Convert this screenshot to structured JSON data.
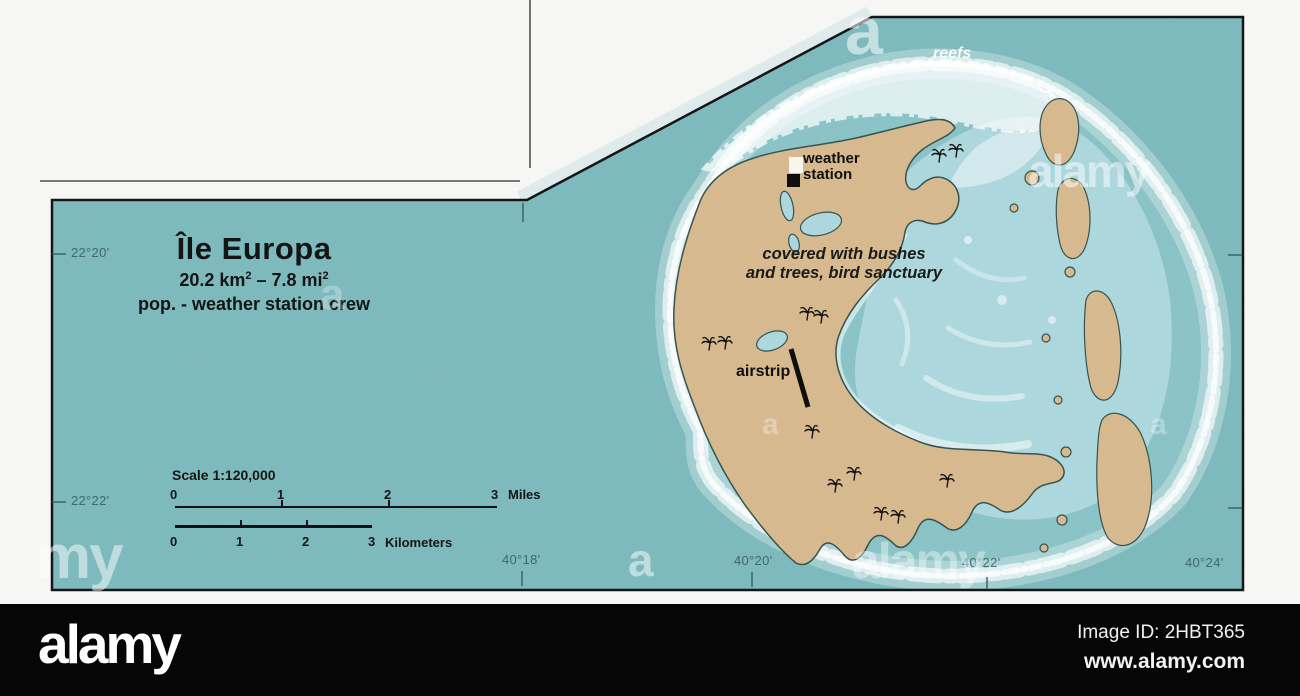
{
  "title_block": {
    "title": "Île Europa",
    "area_base1": "20.2 km",
    "area_sup1": "2",
    "area_base2": " – 7.8 mi",
    "area_sup2": "2",
    "population": "pop. - weather station crew"
  },
  "scale_block": {
    "label": "Scale 1:120,000",
    "miles_ticks": [
      "0",
      "1",
      "2",
      "3"
    ],
    "miles_unit": "Miles",
    "km_ticks": [
      "0",
      "1",
      "2",
      "3"
    ],
    "km_unit": "Kilometers"
  },
  "graticule": {
    "lat_labels": [
      "22°20'",
      "22°22'"
    ],
    "lon_labels": [
      "40°18'",
      "40°20'",
      "40°22'",
      "40°24'"
    ]
  },
  "map_labels": {
    "reefs": "reefs",
    "weather_line1": "weather",
    "weather_line2": "station",
    "vegetation_line1": "covered with bushes",
    "vegetation_line2": "and trees, bird sanctuary",
    "airstrip": "airstrip"
  },
  "watermarks": {
    "big_a": "a",
    "alamy": "alamy",
    "partial_my": "my"
  },
  "alamy_bar": {
    "logo": "alamy",
    "image_id": "Image ID: 2HBT365",
    "website": "www.alamy.com"
  },
  "colors": {
    "ocean": "#7ab8bb",
    "land": "#d6b78c",
    "lagoon": "#aad6dc",
    "reef": "#ffffff",
    "outline": "#2f4f4a",
    "border": "#161616",
    "paper": "#f6f6f4"
  }
}
